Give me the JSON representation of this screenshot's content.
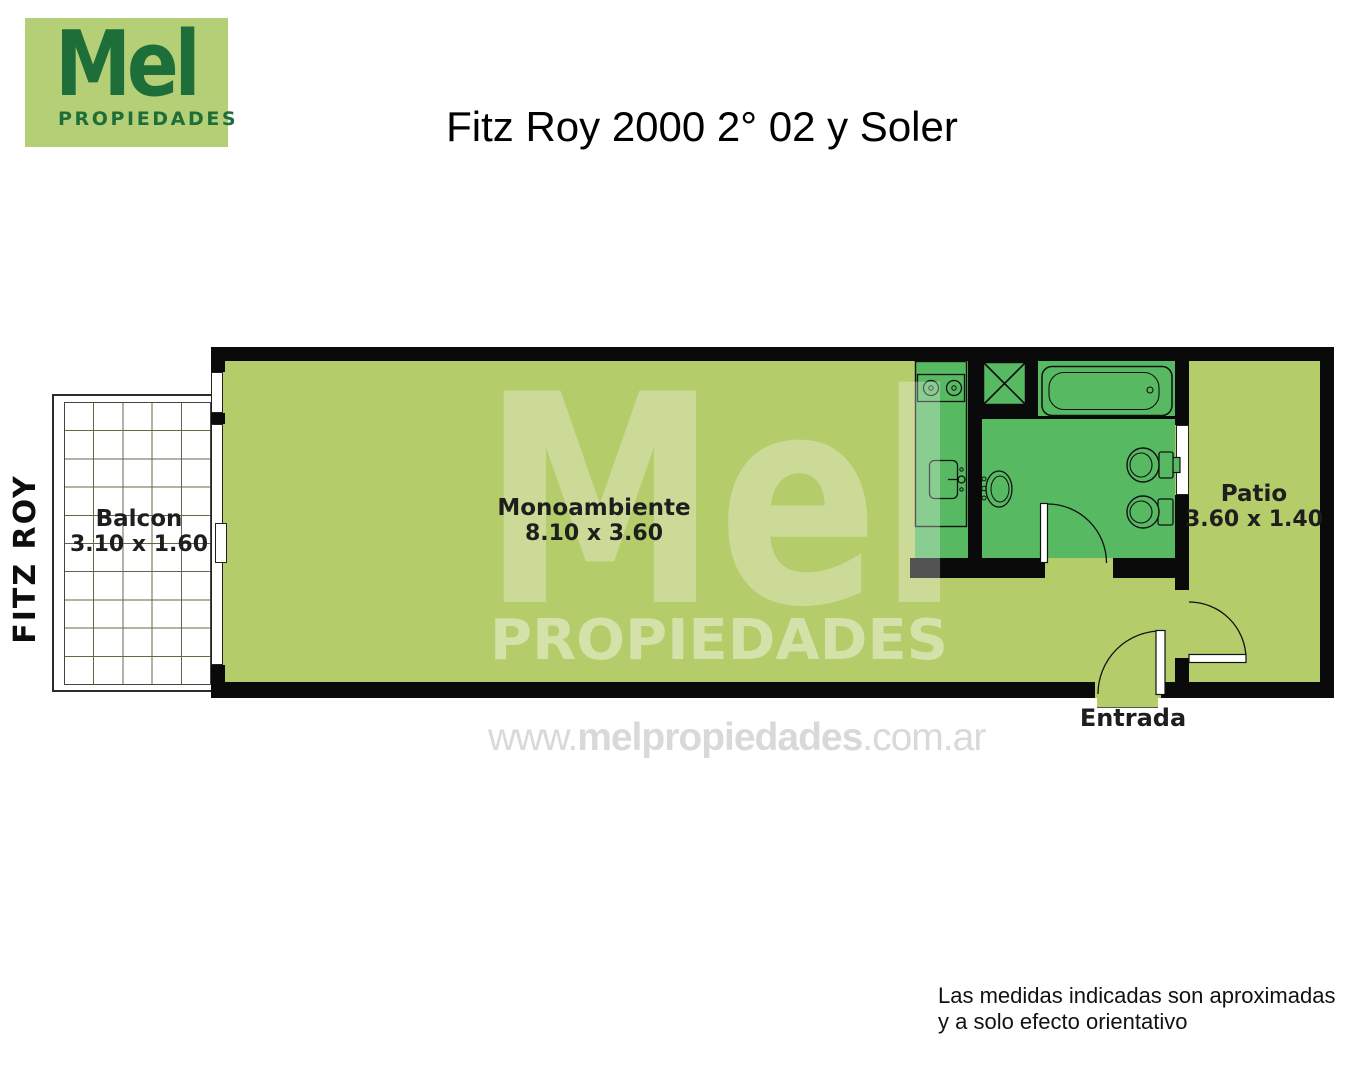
{
  "logo": {
    "brand": "Mel",
    "tagline": "PROPIEDADES"
  },
  "header": {
    "title": "Fitz Roy 2000 2° 02 y Soler"
  },
  "street": {
    "label": "FITZ ROY"
  },
  "rooms": {
    "balcony": {
      "name": "Balcon",
      "dims": "3.10 x 1.60"
    },
    "studio": {
      "name": "Monoambiente",
      "dims": "8.10 x 3.60"
    },
    "patio": {
      "name": "Patio",
      "dims": "3.60 x 1.40"
    },
    "entrance": {
      "label": "Entrada"
    }
  },
  "watermark": {
    "brand": "Mel",
    "tagline": "PROPIEDADES",
    "url_www": "www.",
    "url_domain": "melpropiedades",
    "url_tld": ".com.ar"
  },
  "footer": {
    "disclaimer_line1": "Las medidas indicadas son aproximadas",
    "disclaimer_line2": "y a solo efecto orientativo"
  },
  "colors": {
    "floor_light": "#b5cc6b",
    "floor_dark": "#57b961",
    "wall_black": "#0a0a0a",
    "logo_green_bg": "#b4cf75",
    "logo_green_text": "#1e6e3a",
    "url_gray": "#d9d9d9"
  }
}
